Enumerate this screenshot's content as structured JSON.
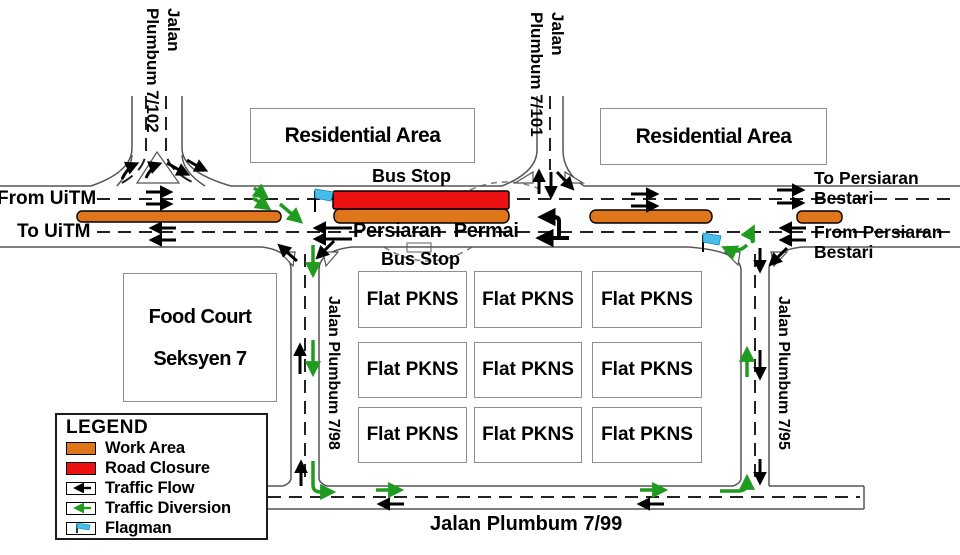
{
  "roads": {
    "jp7102": {
      "line1": "Jalan",
      "line2": "Plumbum 7/102"
    },
    "jp7101": {
      "line1": "Jalan",
      "line2": "Plumbum 7/101"
    },
    "jp798": "Jalan Plumbum 7/98",
    "jp795": "Jalan Plumbum 7/95",
    "jp799": "Jalan Plumbum 7/99",
    "persiaran_permai": "Persiaran Permai"
  },
  "destinations": {
    "from_uitm": "From UiTM",
    "to_uitm": "To UiTM",
    "to_persiaran": {
      "line1": "To Persiaran",
      "line2": "Bestari"
    },
    "from_persiaran": {
      "line1": "From Persiaran",
      "line2": "Bestari"
    }
  },
  "places": {
    "residential_area": "Residential Area",
    "food_court": {
      "line1": "Food Court",
      "line2": "Seksyen 7"
    },
    "flat_pkns": "Flat PKNS",
    "bus_stop": "Bus Stop"
  },
  "legend": {
    "title": "LEGEND",
    "items": [
      {
        "label": "Work Area",
        "color": "#E0761C"
      },
      {
        "label": "Road Closure",
        "color": "#EE1111"
      },
      {
        "label": "Traffic Flow",
        "color": "#000000"
      },
      {
        "label": "Traffic Diversion",
        "color": "#1F9B1F"
      },
      {
        "label": "Flagman",
        "color": "#45BEEA"
      }
    ]
  },
  "colors": {
    "work_area": "#E0761C",
    "road_closure": "#EE1111",
    "traffic_flow": "#000000",
    "traffic_diversion": "#1F9B1F",
    "flagman_flag": "#45BEEA",
    "road_edge": "#555555"
  }
}
